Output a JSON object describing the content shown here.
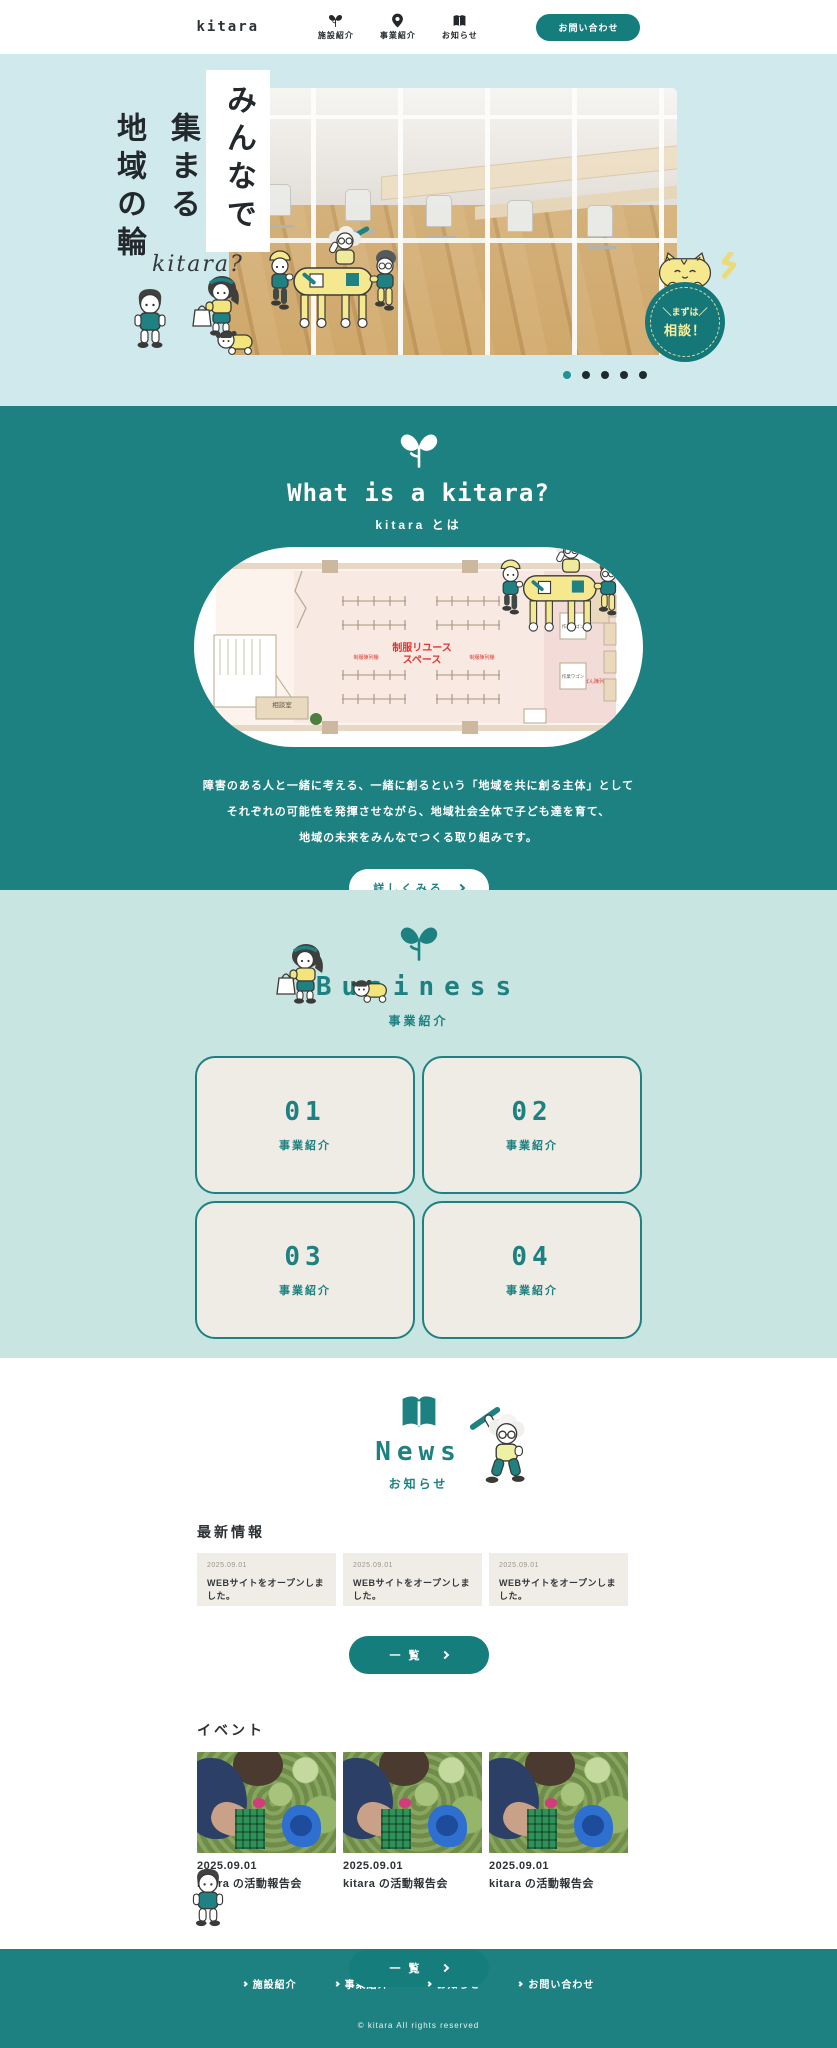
{
  "colors": {
    "teal": "#1e8181",
    "teal_dark": "#157777",
    "hero_bg": "#cfe9ec",
    "business_bg": "#c9e5e2",
    "card_beige": "#efece5",
    "news_card_beige": "#f0ede7",
    "text_dark": "#30363a",
    "accent_yellow": "#f5e88e",
    "accent_red": "#d93a30"
  },
  "header": {
    "logo": "kitara",
    "nav": [
      {
        "label": "施設紹介",
        "icon": "sprout-heart-icon"
      },
      {
        "label": "事業紹介",
        "icon": "map-pin-icon"
      },
      {
        "label": "お知らせ",
        "icon": "book-icon"
      }
    ],
    "contact_button": "お問い合わせ"
  },
  "hero": {
    "catch": [
      "みんなで",
      "集まる",
      "地域の輪"
    ],
    "script_text": "kitara?",
    "badge_top": "＼まずは／",
    "badge_bottom": "相談！",
    "dots": 5,
    "active_dot": 0
  },
  "about": {
    "title": "What is a kitara?",
    "subtitle": "kitara とは",
    "description": [
      "障害のある人と一緒に考える、一緒に創るという「地域を共に創る主体」として",
      "それぞれの可能性を発揮させながら、地域社会全体で子ども達を育て、",
      "地域の未来をみんなでつくる取り組みです。"
    ],
    "more_button": "詳しくみる",
    "floorplan": {
      "main_label_line1": "制服リユース",
      "main_label_line2": "スペース",
      "rack_label": "制服陳列棚",
      "bag_rack_label": "かばん陳列棚",
      "counter_label": "カウンター",
      "wagon_label": "作業ワゴン",
      "room_label": "相談室"
    }
  },
  "business": {
    "title": "Business",
    "subtitle": "事業紹介",
    "cards": [
      {
        "number": "01",
        "label": "事業紹介"
      },
      {
        "number": "02",
        "label": "事業紹介"
      },
      {
        "number": "03",
        "label": "事業紹介"
      },
      {
        "number": "04",
        "label": "事業紹介"
      }
    ]
  },
  "news": {
    "title": "News",
    "subtitle": "お知らせ",
    "latest_heading": "最新情報",
    "latest": [
      {
        "date": "2025.09.01",
        "text": "WEBサイトをオープンしました。"
      },
      {
        "date": "2025.09.01",
        "text": "WEBサイトをオープンしました。"
      },
      {
        "date": "2025.09.01",
        "text": "WEBサイトをオープンしました。"
      }
    ],
    "list_button": "一覧",
    "events_heading": "イベント",
    "events": [
      {
        "date": "2025.09.01",
        "title": "kitara の活動報告会"
      },
      {
        "date": "2025.09.01",
        "title": "kitara の活動報告会"
      },
      {
        "date": "2025.09.01",
        "title": "kitara の活動報告会"
      }
    ],
    "events_list_button": "一覧"
  },
  "footer": {
    "links": [
      {
        "label": "施設紹介"
      },
      {
        "label": "事業紹介"
      },
      {
        "label": "お知らせ"
      },
      {
        "label": "お問い合わせ"
      }
    ],
    "copyright": "© kitara All rights reserved"
  }
}
